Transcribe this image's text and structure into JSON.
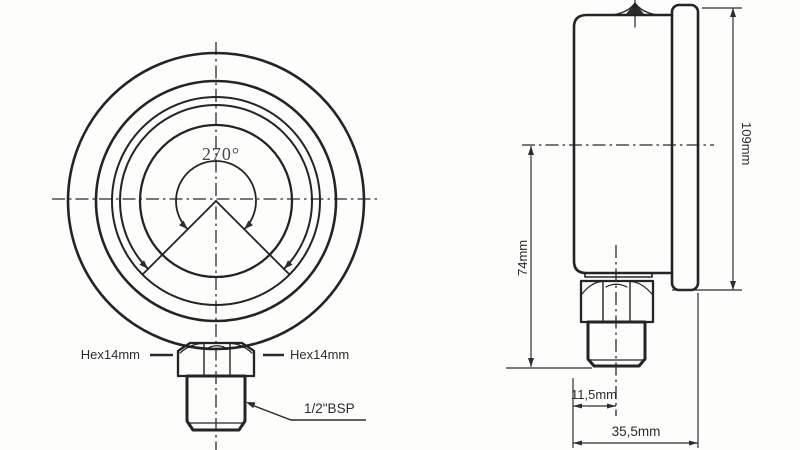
{
  "drawing": {
    "front_view": {
      "sweep_angle": "270°",
      "hex_left": "Hex14mm",
      "hex_right": "Hex14mm",
      "thread": "1/2\"BSP"
    },
    "side_view": {
      "overall_height": "109mm",
      "center_to_thread_end": "74mm",
      "face_to_axis": "11,5mm",
      "overall_depth": "35,5mm"
    },
    "colors": {
      "line": "#242424",
      "background": "#fdfdfc"
    }
  }
}
